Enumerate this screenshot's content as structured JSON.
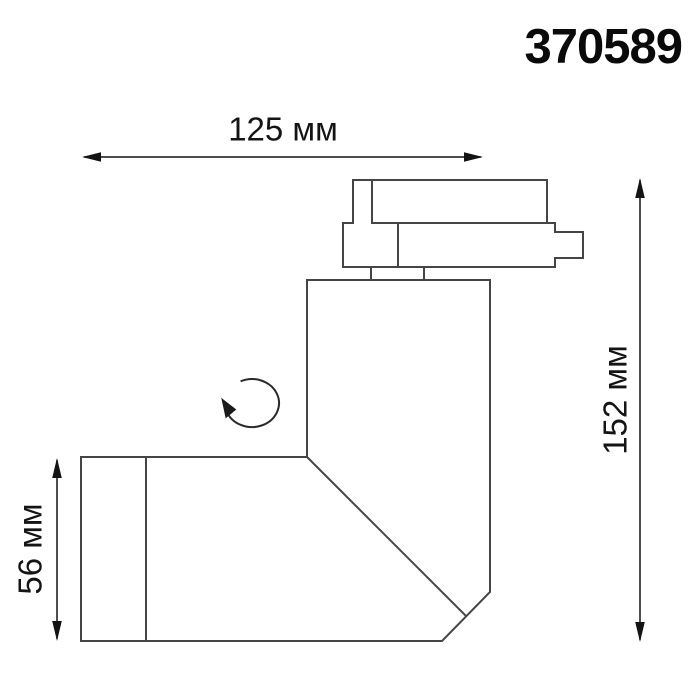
{
  "title": "370589",
  "dimensions": {
    "width": {
      "label": "125 мм"
    },
    "height": {
      "label": "152 мм"
    },
    "body_height": {
      "label": "56 мм"
    }
  },
  "icons": [
    {
      "name": "rotation-arrow-icon"
    }
  ],
  "colors": {
    "background": "#ffffff",
    "drawing_line": "#454545",
    "dimension_line": "#141414",
    "text": "#141414"
  }
}
